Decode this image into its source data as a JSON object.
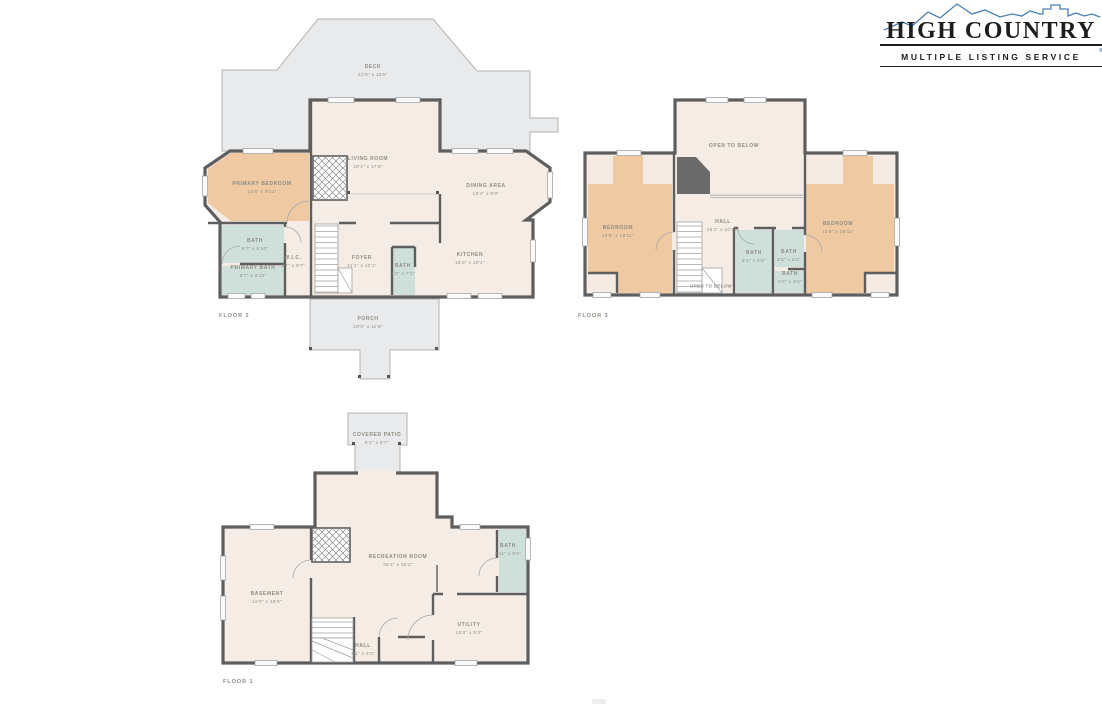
{
  "logo": {
    "title": "HIGH COUNTRY",
    "subtitle": "MULTIPLE LISTING SERVICE",
    "registered_mark": "®",
    "mountain_color": "#4a7fb2",
    "text_color": "#1d1d1b"
  },
  "palette": {
    "deck_gray": "#e9eaeb",
    "interior_cream": "#f5ece5",
    "bedroom_tan": "#eec9a1",
    "bath_blue": "#cfe0da",
    "wall_dark": "#5e5e5e",
    "label_text": "#8e8c83"
  },
  "floor2": {
    "label": "FLOOR 2",
    "rooms": {
      "deck": {
        "name": "DECK",
        "dims": "43'9\" x 16'5\""
      },
      "primary_bedroom": {
        "name": "PRIMARY BEDROOM",
        "dims": "14'6\" x 9'11\""
      },
      "living_room": {
        "name": "LIVING ROOM",
        "dims": "18'1\" x 17'5\""
      },
      "dining_area": {
        "name": "DINING AREA",
        "dims": "13'4\" x 9'9\""
      },
      "bath": {
        "name": "BATH",
        "dims": "8'7\" x 5'10\""
      },
      "primary_bath": {
        "name": "PRIMARY BATH",
        "dims": "8'7\" x 3'10\""
      },
      "wic": {
        "name": "W.I.C.",
        "dims": "5'7\" x 9'7\""
      },
      "foyer": {
        "name": "FOYER",
        "dims": "11'1\" x 10'1\""
      },
      "foyer_bath": {
        "name": "BATH",
        "dims": "7'2\" x 7'1\""
      },
      "kitchen": {
        "name": "KITCHEN",
        "dims": "16'3\" x 10'1\""
      },
      "porch": {
        "name": "PORCH",
        "dims": "18'0\" x 11'9\""
      }
    }
  },
  "floor3": {
    "label": "FLOOR 3",
    "rooms": {
      "open_to_below": {
        "name": "OPEN TO BELOW"
      },
      "bedroom_left": {
        "name": "BEDROOM",
        "dims": "12'6\" x 19'11\""
      },
      "hall": {
        "name": "HALL",
        "dims": "18'1\" x 10'10\""
      },
      "bedroom_right": {
        "name": "BEDROOM",
        "dims": "12'9\" x 19'11\""
      },
      "bath_1": {
        "name": "BATH",
        "dims": "5'1\" x 9'8\""
      },
      "bath_2": {
        "name": "BATH",
        "dims": "3'5\" x 6'2\""
      },
      "bath_3": {
        "name": "BATH",
        "dims": "3'5\" x 3'5\""
      },
      "open_to_below_small": {
        "name": "OPEN TO BELOW"
      }
    }
  },
  "floor1": {
    "label": "FLOOR 1",
    "rooms": {
      "covered_patio": {
        "name": "COVERED PATIO",
        "dims": "8'4\" x 8'7\""
      },
      "recreation_room": {
        "name": "RECREATION ROOM",
        "dims": "36'2\" x 26'2\""
      },
      "basement": {
        "name": "BASEMENT",
        "dims": "12'0\" x 18'9\""
      },
      "bath": {
        "name": "BATH",
        "dims": "3'11\" x 9'2\""
      },
      "utility": {
        "name": "UTILITY",
        "dims": "13'0\" x 9'3\""
      },
      "hall": {
        "name": "HALL",
        "dims": "4'1\" x 3'2\""
      }
    }
  }
}
